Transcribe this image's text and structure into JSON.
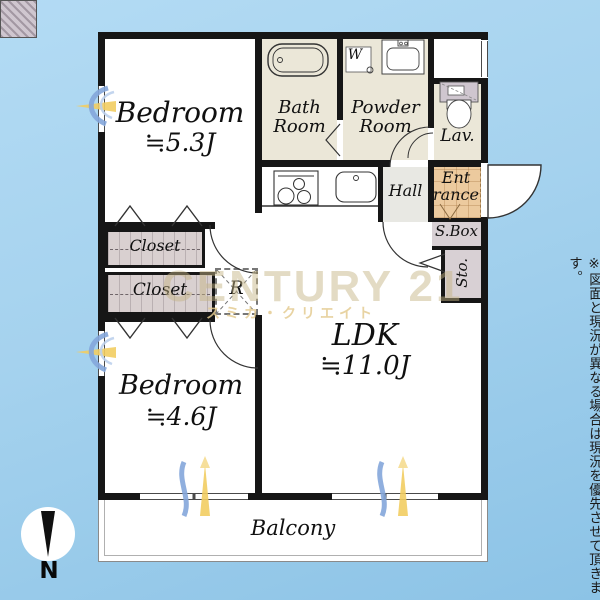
{
  "side_note": "※図面と現況が異なる場合は現況を優先させて頂きます。",
  "watermark": {
    "brand": "CENTURY 21",
    "subtitle": "スミカ・クリエイト"
  },
  "compass": {
    "label": "N"
  },
  "rooms": {
    "bedroom1": {
      "name": "Bedroom",
      "size": "≒5.3J"
    },
    "bedroom2": {
      "name": "Bedroom",
      "size": "≒4.6J"
    },
    "ldk": {
      "name": "LDK",
      "size": "≒11.0J"
    },
    "bath": {
      "line1": "Bath",
      "line2": "Room"
    },
    "powder": {
      "line1": "Powder",
      "line2": "Room"
    },
    "lav": "Lav.",
    "hall": "Hall",
    "entrance": {
      "line1": "Ent",
      "line2": "rance"
    },
    "shoe_box": "S.Box",
    "storage": "Sto.",
    "closet1": "Closet",
    "closet2": "Closet",
    "refrigerator": "R",
    "washer": "W",
    "balcony": "Balcony"
  },
  "colors": {
    "background": "#a5d2ee",
    "wall": "#161616",
    "wet_area": "#ebe7d8",
    "entrance_tile": "#ecca9e",
    "closet": "#d9d0d0",
    "hall": "#e8e8e3",
    "storage_gray": "#d8d0d4",
    "accent_blue": "#84a6da",
    "accent_yellow": "#f2cd62",
    "watermark_gold": "#c5b384"
  }
}
